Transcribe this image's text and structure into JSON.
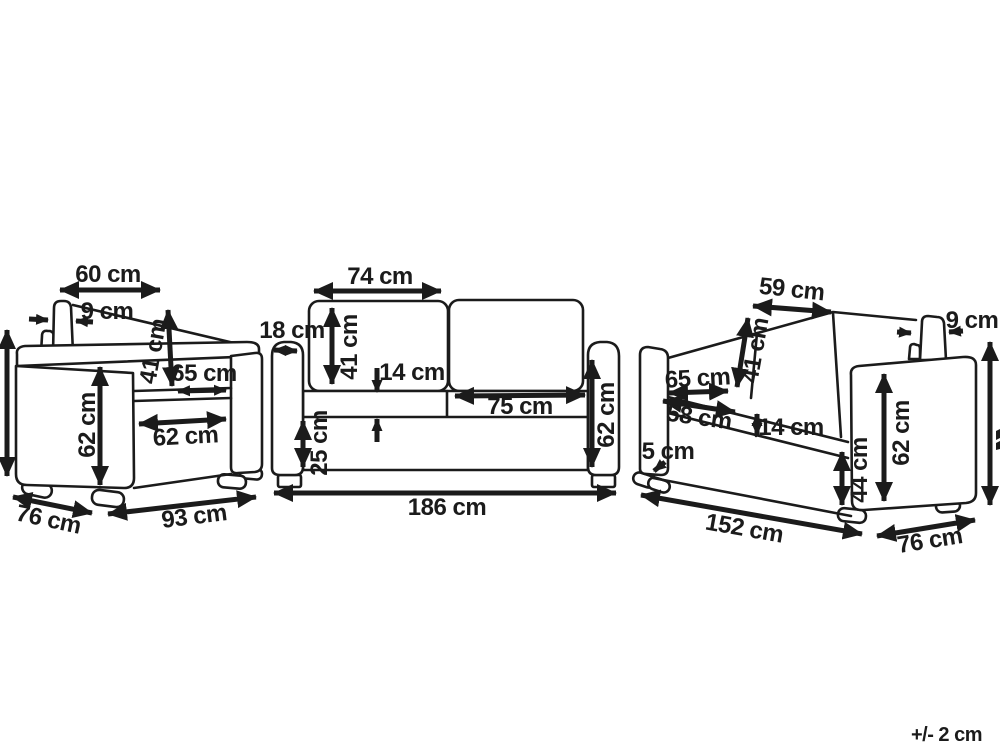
{
  "ink_color": "#1b1b1b",
  "armchair": {
    "top_width": "60 cm",
    "back_cushion_thickness": "9 cm",
    "backrest_height": "41 cm",
    "seat_width": "65 cm",
    "seat_front_width": "62 cm",
    "side_height": "62 cm",
    "depth": "76 cm",
    "total_width": "93 cm"
  },
  "sofa_3seat": {
    "cushion_width": "74 cm",
    "armrest_width": "18 cm",
    "backrest_height": "41 cm",
    "seat_cushion_thickness": "14 cm",
    "seat_width": "75 cm",
    "base_height": "25 cm",
    "side_height": "62 cm",
    "total_width": "186 cm"
  },
  "sofa_2seat": {
    "cushion_width": "59 cm",
    "backrest_height": "41 cm",
    "back_cushion_thickness": "9 cm",
    "seat_width": "65 cm",
    "seat_front_width": "58 cm",
    "seat_cushion_thickness": "14 cm",
    "leg_height": "5 cm",
    "seat_height": "44 cm",
    "side_height": "62 cm",
    "total_width": "152 cm",
    "depth": "76 cm"
  },
  "footnote": {
    "tolerance": "+/- 2 cm"
  }
}
